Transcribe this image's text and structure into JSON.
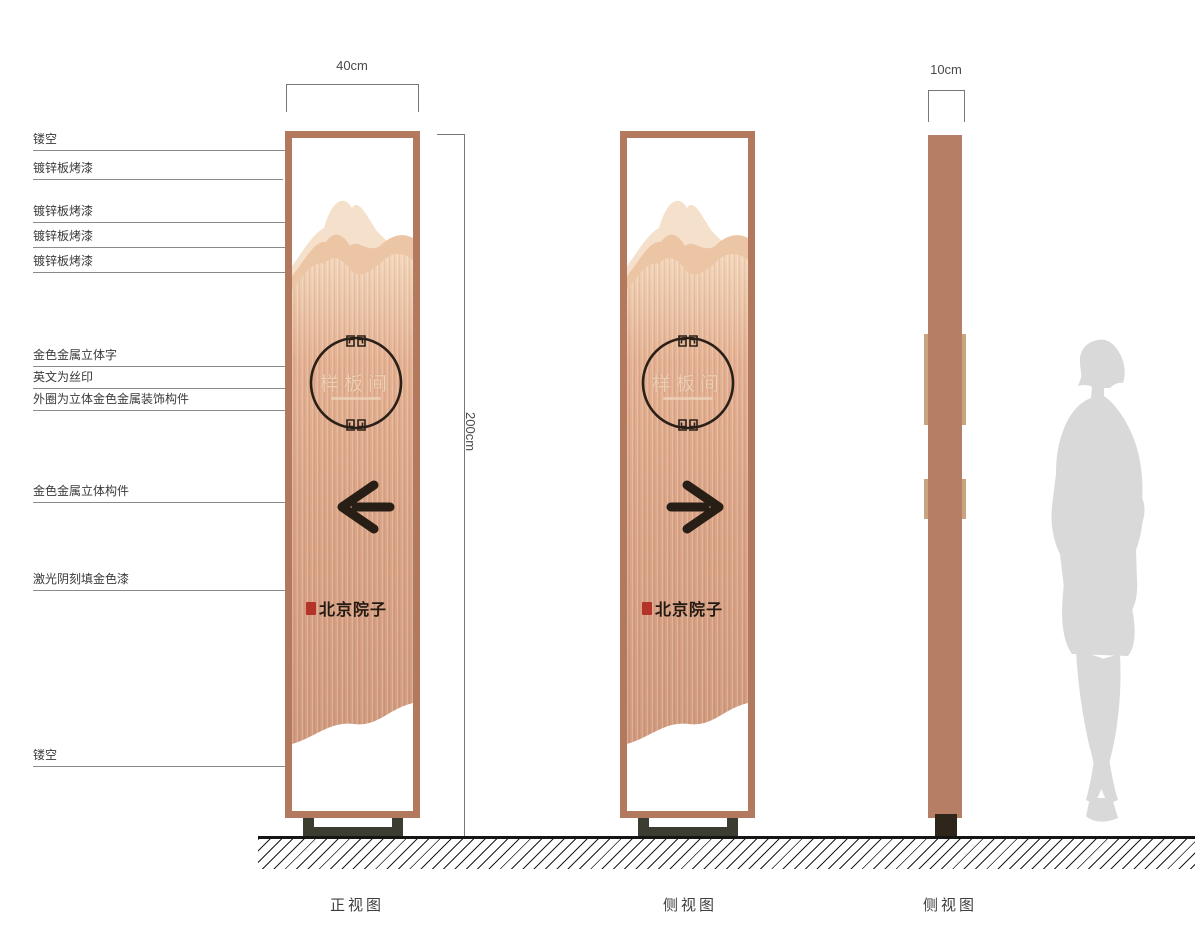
{
  "dims": {
    "front_width": "40cm",
    "total_height": "200cm",
    "side_width": "10cm"
  },
  "callouts": [
    "镂空",
    "镀锌板烤漆",
    "镀锌板烤漆",
    "镀锌板烤漆",
    "镀锌板烤漆",
    "金色金属立体字",
    "英文为丝印",
    "外圈为立体金色金属装饰构件",
    "金色金属立体构件",
    "激光阴刻填金色漆",
    "镂空"
  ],
  "sign": {
    "plate_text": "样板间",
    "brand": "北京院子"
  },
  "captions": [
    "正视图",
    "侧视图",
    "侧视图"
  ],
  "icons": {
    "arrow_left": "←",
    "arrow_right": "→",
    "meander_ornament": "回纹",
    "seal_stamp": "印章",
    "human_silhouette": "人形比例"
  },
  "colors": {
    "copper_frame": "#b3795e",
    "copper_light": "#f2d4b8",
    "copper_deep": "#cf977a",
    "mountain_back": "#f5e1cb",
    "mountain_mid": "#ecc5a4",
    "dark_accent": "#271e15",
    "base_olive": "#3c3c30",
    "side_trim": "#c9a37f",
    "seal_red": "#b5342a",
    "silhouette_gray": "#d9d9d9"
  }
}
